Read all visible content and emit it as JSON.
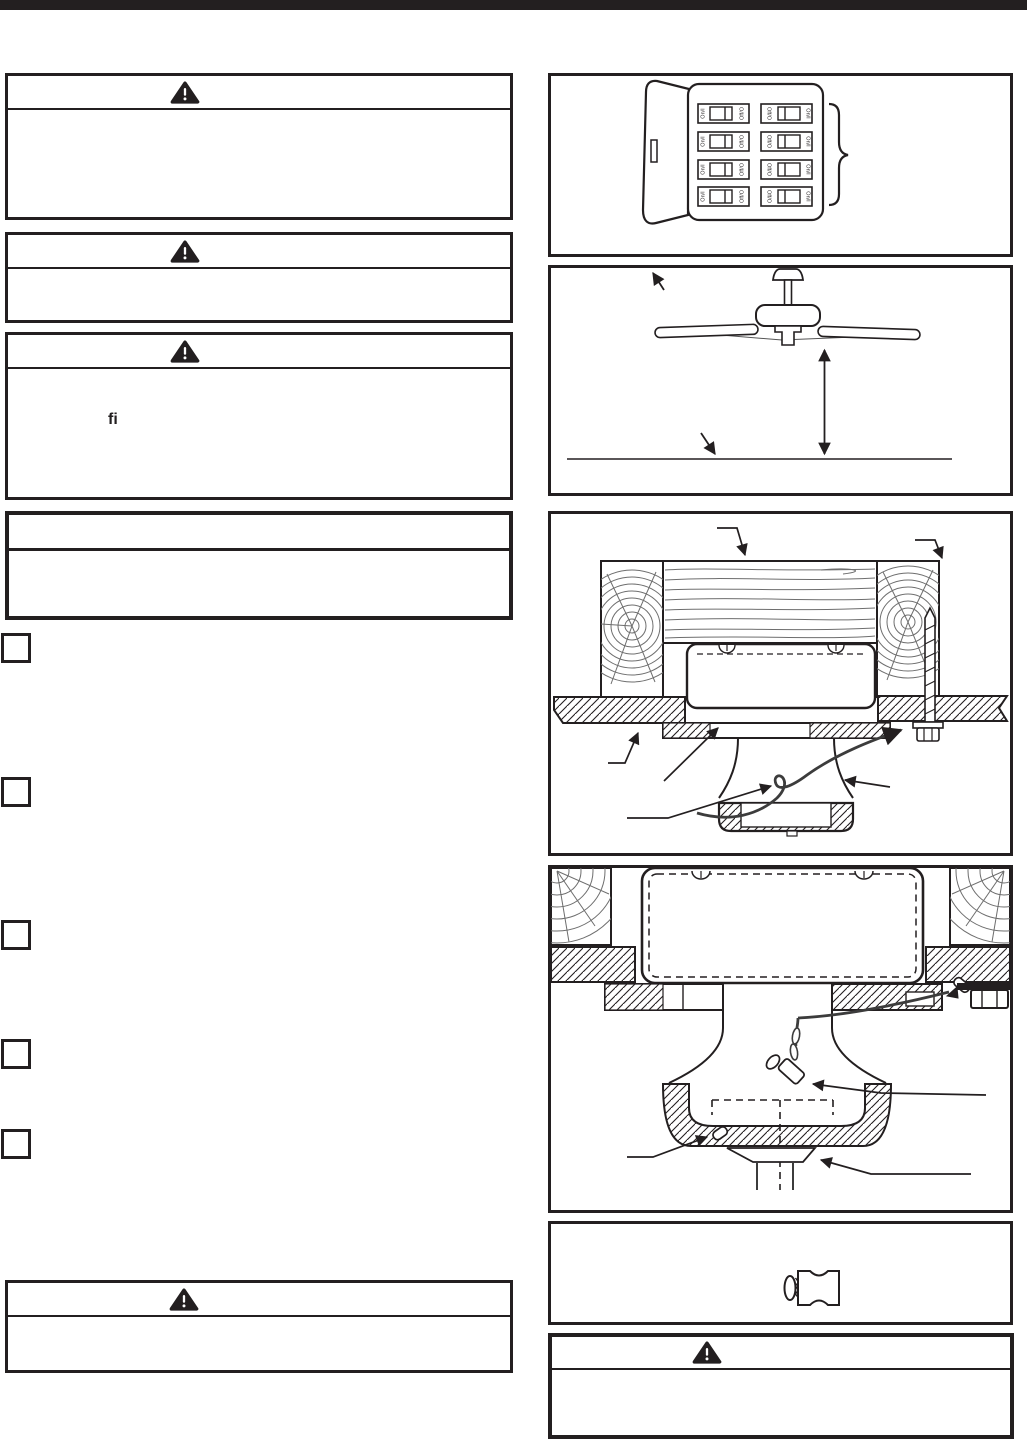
{
  "page": {
    "background": "#ffffff",
    "ink": "#231f20",
    "top_bar_color": "#231f20"
  },
  "left_column": {
    "warning_box_top": {
      "icon": "warning-triangle-icon"
    },
    "warning_box_second": {
      "icon": "warning-triangle-icon"
    },
    "warning_box_third": {
      "icon": "warning-triangle-icon",
      "visible_text_fragment": "fi"
    },
    "notice_box": {
      "icon": "none"
    },
    "step_markers_count": "5",
    "warning_box_bottom": {
      "icon": "warning-triangle-icon"
    }
  },
  "right_column": {
    "breaker_panel_figure": {
      "name": "circuit-breaker-panel-diagram",
      "on_label": "On/I",
      "off_label": "Off/O"
    },
    "ceiling_fan_figure": {
      "name": "ceiling-fan-floor-clearance-diagram"
    },
    "brace_outlet_box_figure": {
      "name": "joists-brace-outlet-box-diagram"
    },
    "bracket_cable_figure": {
      "name": "mounting-bracket-safety-cable-diagram"
    },
    "wire_connector_figure": {
      "name": "wire-connector-diagram"
    },
    "warning_box": {
      "icon": "warning-triangle-icon"
    }
  }
}
